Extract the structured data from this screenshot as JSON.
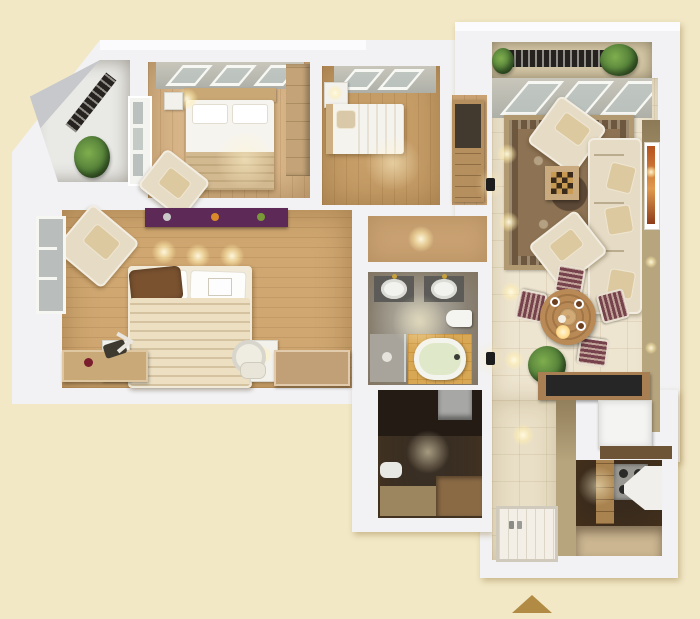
{
  "scene": {
    "type": "3d-floorplan-render",
    "title": "Two-bedroom apartment 3D floor plan (top-down render)",
    "watermark": "gold-triangle"
  },
  "colors": {
    "background": "#f2e8c6",
    "wall": "#f2f2f4",
    "wall_bright": "#fbfbfd",
    "accent_wall": "#b7a57e",
    "rug_field": "#8d7354",
    "rug_border": "#b19a72",
    "sofa": "#e6dcc6",
    "dining_chair": "#76434d",
    "table_wood": "#b98a55",
    "plant": "#4e7a36",
    "console": "#262626",
    "tub_platform": "#d9a855",
    "tub": "#dfe8c8",
    "purple_shelf": "#5d2a57",
    "watermark": "#b18a44"
  },
  "rooms": [
    {
      "name": "balcony-top-left",
      "floor": "#e9e9e6",
      "furniture": [
        "railing",
        "potted-plant"
      ]
    },
    {
      "name": "bedroom-1",
      "floor": "#d9b689",
      "furniture": [
        "double-bed",
        "headboard-shelf",
        "ceiling-lamp",
        "nightstand",
        "wardrobe",
        "armchair",
        "window-band",
        "balcony-door"
      ]
    },
    {
      "name": "bedroom-2",
      "floor": "#c79e68",
      "furniture": [
        "single-bed",
        "pillow",
        "nightstand",
        "table-lamp",
        "wardrobe-cabinet",
        "window-band"
      ]
    },
    {
      "name": "hallway",
      "floor": "#c9a172",
      "furniture": [
        "tv-cabinet",
        "downlight"
      ]
    },
    {
      "name": "living-dining",
      "floor": "#eee5d0",
      "furniture": [
        "sofa",
        "armchair-top",
        "armchair-bottom",
        "chess-coffee-table",
        "oriental-rug",
        "wall-painting",
        "window-band",
        "wall-sconces",
        "round-dining-table",
        "dining-chairs",
        "potted-plant",
        "media-console"
      ]
    },
    {
      "name": "bathroom",
      "floor": "#8f8a80",
      "furniture": [
        "vanity-sink-left",
        "vanity-sink-right",
        "wall-hung-toilet",
        "bathtub",
        "tub-platform",
        "shower-corner"
      ]
    },
    {
      "name": "master-bedroom",
      "floor": "#d0a771",
      "furniture": [
        "double-bed",
        "nightstand-left",
        "nightstand-right",
        "table-lamps",
        "purple-wall-shelf",
        "armchair",
        "window",
        "storage-chest",
        "bench",
        "rocking-toy",
        "vanity-mirror",
        "pouf"
      ]
    },
    {
      "name": "utility-room",
      "floor": "#3a2f24",
      "furniture": [
        "washing-machine",
        "toilet",
        "wood-shelf"
      ]
    },
    {
      "name": "entry",
      "floor": "#e9dfc6",
      "furniture": [
        "shower-tray",
        "toiletry-bottles"
      ]
    },
    {
      "name": "kitchen",
      "floor": "#372a1e",
      "floor_light": "#cbb691",
      "furniture": [
        "gas-stove",
        "extractor-hood",
        "cabinets",
        "refrigerator",
        "counter"
      ]
    },
    {
      "name": "balcony-top-right",
      "floor": "#d6c9a8",
      "furniture": [
        "wrought-iron-railing",
        "potted-plants"
      ]
    }
  ]
}
